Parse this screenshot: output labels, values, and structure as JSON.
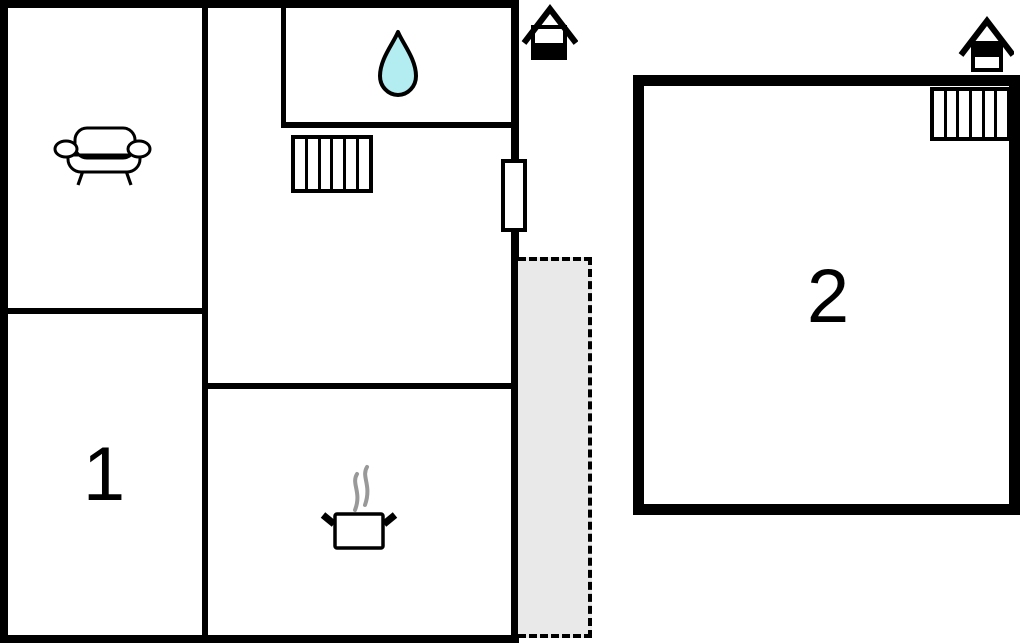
{
  "floorplan": {
    "background": "#ffffff",
    "wall_color": "#000000",
    "unit1": {
      "label": "1",
      "features": [
        "sofa",
        "water-drop",
        "radiator",
        "cooking-pot",
        "door",
        "terrace",
        "entrance-marker"
      ]
    },
    "unit2": {
      "label": "2",
      "features": [
        "radiator",
        "entrance-marker"
      ]
    },
    "colors": {
      "terrace_fill": "#e9e9e9",
      "water_drop_fill": "#b3edf2",
      "steam": "#999999"
    }
  }
}
